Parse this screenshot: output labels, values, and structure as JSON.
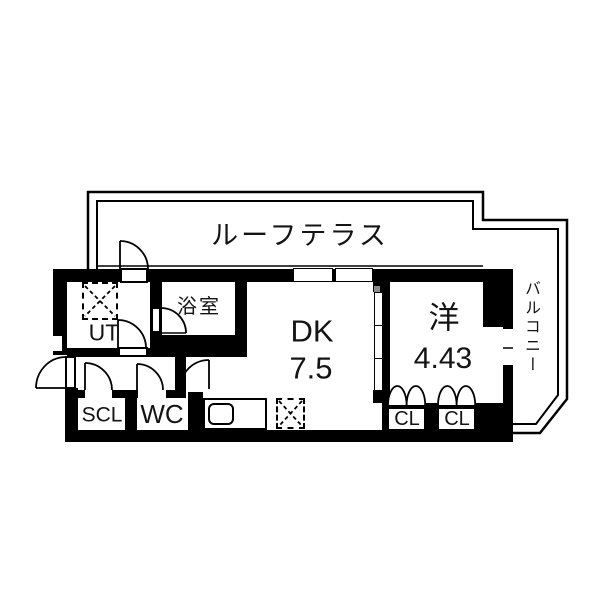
{
  "plan": {
    "type": "apartment-floor-plan",
    "terrace": {
      "label": "ルーフテラス"
    },
    "balcony": {
      "label": "バルコニー"
    },
    "rooms": {
      "ut": {
        "label": "UT"
      },
      "bath": {
        "label": "浴室"
      },
      "dk": {
        "label": "DK",
        "size": "7.5"
      },
      "western": {
        "label": "洋",
        "size": "4.43"
      },
      "scl": {
        "label": "SCL"
      },
      "wc": {
        "label": "WC"
      },
      "closet1": {
        "label": "CL"
      },
      "closet2": {
        "label": "CL"
      }
    },
    "fixtures": {
      "washer_pan": "dashed-square-x",
      "refrigerator_space": "dashed-square-x",
      "kitchen_sink": "rounded-rect"
    },
    "colors": {
      "wall": "#000000",
      "background": "#ffffff",
      "line": "#000000",
      "door_pocket_gray": "#8d8d8d"
    }
  }
}
